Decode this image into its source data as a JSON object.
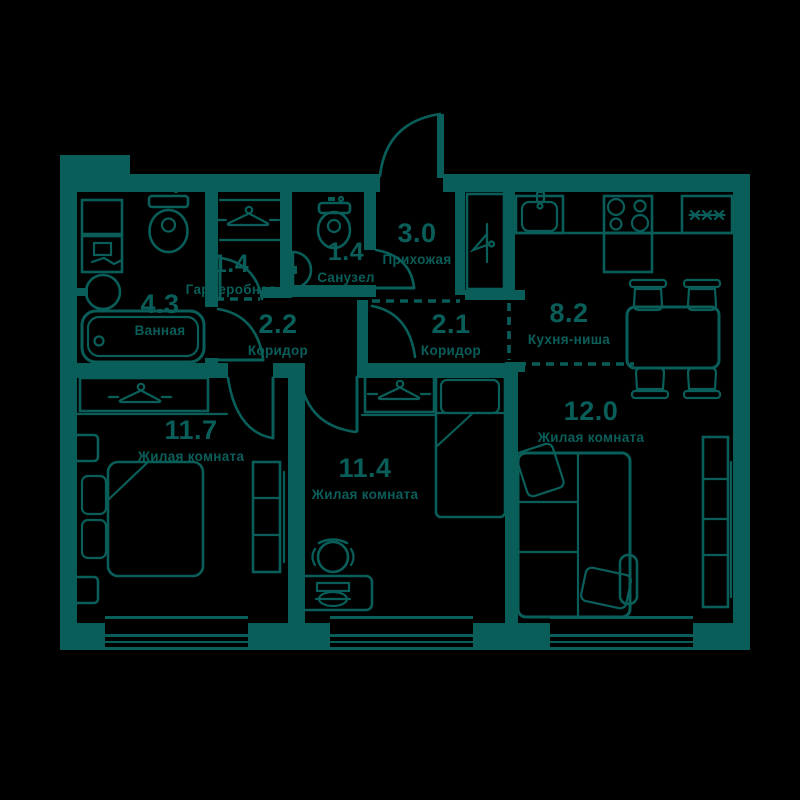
{
  "colors": {
    "wall": "#0A5E5A",
    "background": "#000000"
  },
  "rooms": {
    "bathroom": {
      "area": "4.3",
      "name": "Ванная"
    },
    "wardrobe": {
      "area": "1.4",
      "name": "Гардеробная"
    },
    "wc": {
      "area": "1.4",
      "name": "Санузел"
    },
    "hallway": {
      "area": "3.0",
      "name": "Прихожая"
    },
    "corridor_a": {
      "area": "2.2",
      "name": "Коридор"
    },
    "corridor_b": {
      "area": "2.1",
      "name": "Коридор"
    },
    "kitchen": {
      "area": "8.2",
      "name": "Кухня-ниша"
    },
    "living_1": {
      "area": "11.7",
      "name": "Жилая комната"
    },
    "living_2": {
      "area": "11.4",
      "name": "Жилая комната"
    },
    "living_3": {
      "area": "12.0",
      "name": "Жилая комната"
    }
  },
  "fixtures": [
    "bathtub",
    "toilet",
    "washing-machine",
    "round-sink",
    "wall-sink",
    "hanger",
    "closet",
    "mirror-cabinet",
    "kitchen-sink",
    "stove",
    "fridge",
    "kitchen-counter",
    "dining-table",
    "chair",
    "double-bed",
    "single-bed",
    "desk",
    "office-chair",
    "corner-sofa",
    "shelving",
    "window",
    "entrance-door",
    "door-swing"
  ]
}
